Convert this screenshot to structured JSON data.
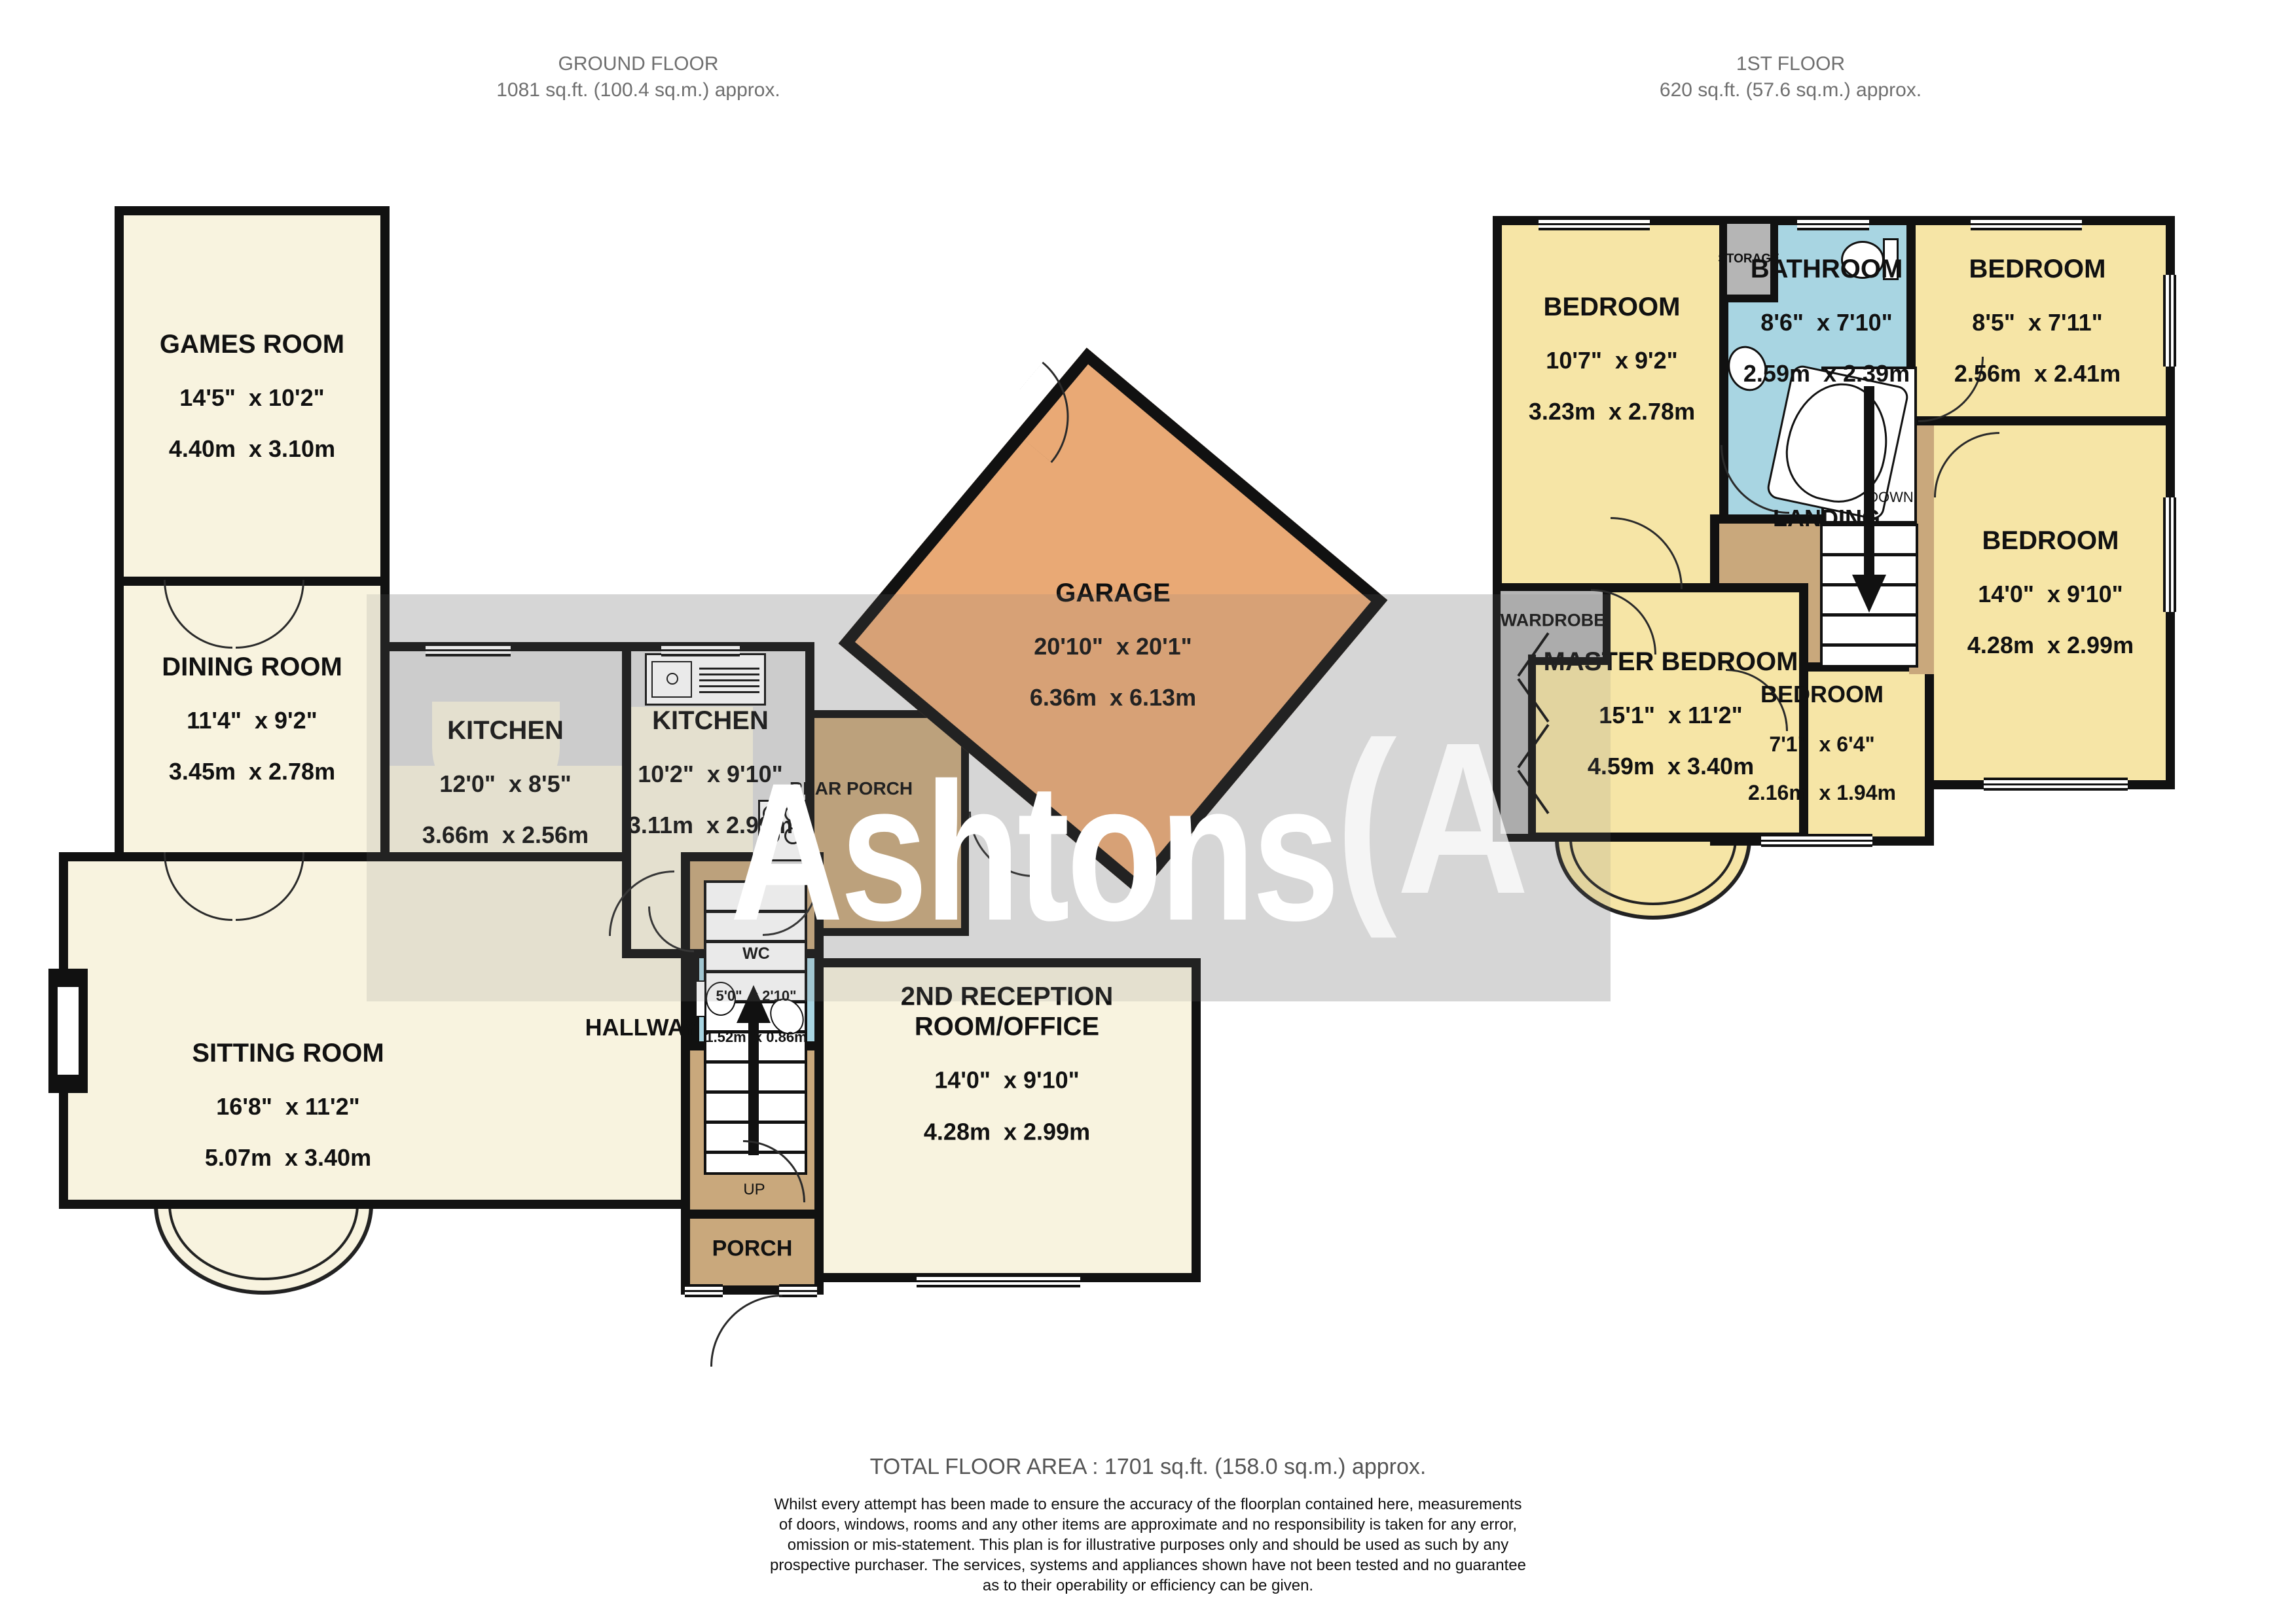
{
  "titles": {
    "ground": {
      "name": "GROUND FLOOR",
      "area": "1081 sq.ft. (100.4 sq.m.) approx."
    },
    "first": {
      "name": "1ST FLOOR",
      "area": "620 sq.ft. (57.6 sq.m.) approx."
    }
  },
  "watermark": {
    "text": "Ashtons",
    "mark": "(A"
  },
  "ground_floor": {
    "rooms": [
      {
        "name": "GAMES ROOM",
        "imperial": "14'5\"  x 10'2\"",
        "metric": "4.40m  x 3.10m"
      },
      {
        "name": "DINING ROOM",
        "imperial": "11'4\"  x 9'2\"",
        "metric": "3.45m  x 2.78m"
      },
      {
        "name": "KITCHEN",
        "imperial": "12'0\"  x 8'5\"",
        "metric": "3.66m  x 2.56m"
      },
      {
        "name": "KITCHEN",
        "imperial": "10'2\"  x 9'10\"",
        "metric": "3.11m  x 2.99m"
      },
      {
        "name": "GARAGE",
        "imperial": "20'10\"  x 20'1\"",
        "metric": "6.36m  x 6.13m"
      },
      {
        "name": "SITTING ROOM",
        "imperial": "16'8\"  x 11'2\"",
        "metric": "5.07m  x 3.40m"
      },
      {
        "name": "2ND RECEPTION\nROOM/OFFICE",
        "imperial": "14'0\"  x 9'10\"",
        "metric": "4.28m  x 2.99m"
      },
      {
        "name": "WC",
        "imperial": "5'0\"  x 2'10\"",
        "metric": "1.52m  x 0.86m"
      }
    ],
    "labels": {
      "hallway": "HALLWAY",
      "up": "UP",
      "porch": "PORCH",
      "rear_porch": "REAR PORCH"
    }
  },
  "first_floor": {
    "rooms": [
      {
        "name": "BEDROOM",
        "imperial": "10'7\"  x 9'2\"",
        "metric": "3.23m  x 2.78m"
      },
      {
        "name": "BATHROOM",
        "imperial": "8'6\"  x 7'10\"",
        "metric": "2.59m  x 2.39m"
      },
      {
        "name": "BEDROOM",
        "imperial": "8'5\"  x 7'11\"",
        "metric": "2.56m  x 2.41m"
      },
      {
        "name": "MASTER BEDROOM",
        "imperial": "15'1\"  x 11'2\"",
        "metric": "4.59m  x 3.40m"
      },
      {
        "name": "BEDROOM",
        "imperial": "7'1\"  x 6'4\"",
        "metric": "2.16m  x 1.94m"
      },
      {
        "name": "BEDROOM",
        "imperial": "14'0\"  x 9'10\"",
        "metric": "4.28m  x 2.99m"
      }
    ],
    "labels": {
      "landing": "LANDING",
      "down": "DOWN",
      "storage": "STORAGE",
      "wardrobe": "WARDROBE"
    }
  },
  "footer": {
    "total": "TOTAL FLOOR AREA : 1701 sq.ft. (158.0 sq.m.) approx.",
    "disclaimer": [
      "Whilst every attempt has been made to ensure the accuracy of the floorplan contained here, measurements",
      "of doors, windows, rooms and any other items are approximate and no responsibility is taken for any error,",
      "omission or mis-statement. This plan is for illustrative purposes only and should be used as such by any",
      "prospective purchaser. The services, systems and appliances shown have not been tested and no guarantee",
      "as to their operability or efficiency can be given."
    ],
    "credit": "Made with Metropix ©2026"
  },
  "colors": {
    "room_cream": "#F8F3DF",
    "room_yellow": "#F6E5A6",
    "hall_brown": "#C9A87C",
    "garage_orange": "#E9A975",
    "wet_blue": "#A8D5E2",
    "counter_gray": "#DCDCDC",
    "storage_gray": "#B5B5B5",
    "wall": "#111111",
    "watermark_band": "#E7E7E7"
  }
}
